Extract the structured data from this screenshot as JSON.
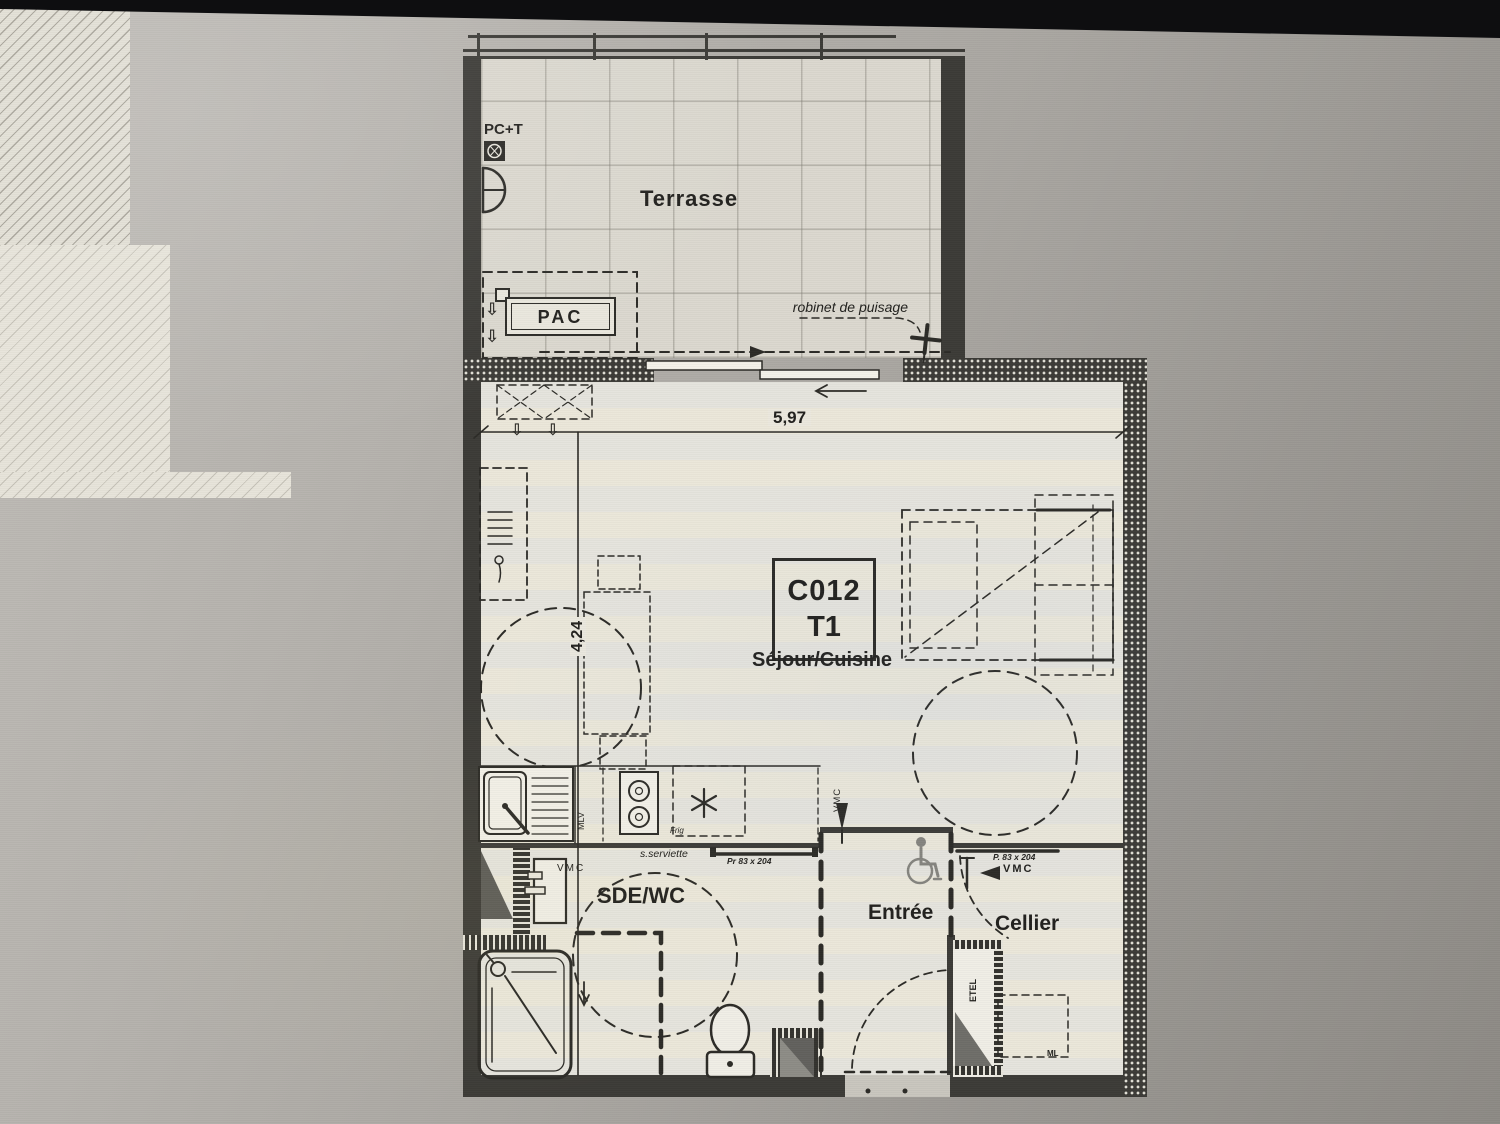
{
  "unit": {
    "code": "C012",
    "type": "T1"
  },
  "rooms": {
    "terrace": "Terrasse",
    "living": "Séjour/Cuisine",
    "bathroom": "SDE/WC",
    "entry": "Entrée",
    "storage": "Cellier"
  },
  "dimensions": {
    "width_m": "5,97",
    "depth_m": "4,24"
  },
  "equipment": {
    "heat_pump": "PAC",
    "socket": "PC+T",
    "outdoor_tap": "robinet de puisage",
    "dishwasher": "MLV",
    "fridge": "Frig",
    "towel_rail": "s.serviette",
    "vmc": "VMC",
    "electrical_panel": "ETEL",
    "washer": "ML"
  },
  "doors": {
    "bathroom_door": "Pr 83 x 204",
    "storage_door": "P. 83 x 204"
  },
  "symbols": {
    "down_arrow": "⇩"
  },
  "colors": {
    "wall": "#3c3b37",
    "paper": "#eae7dd",
    "terrace_floor": "#dbd8cf",
    "line": "#2c2b27",
    "background": "#a8a5a0"
  }
}
